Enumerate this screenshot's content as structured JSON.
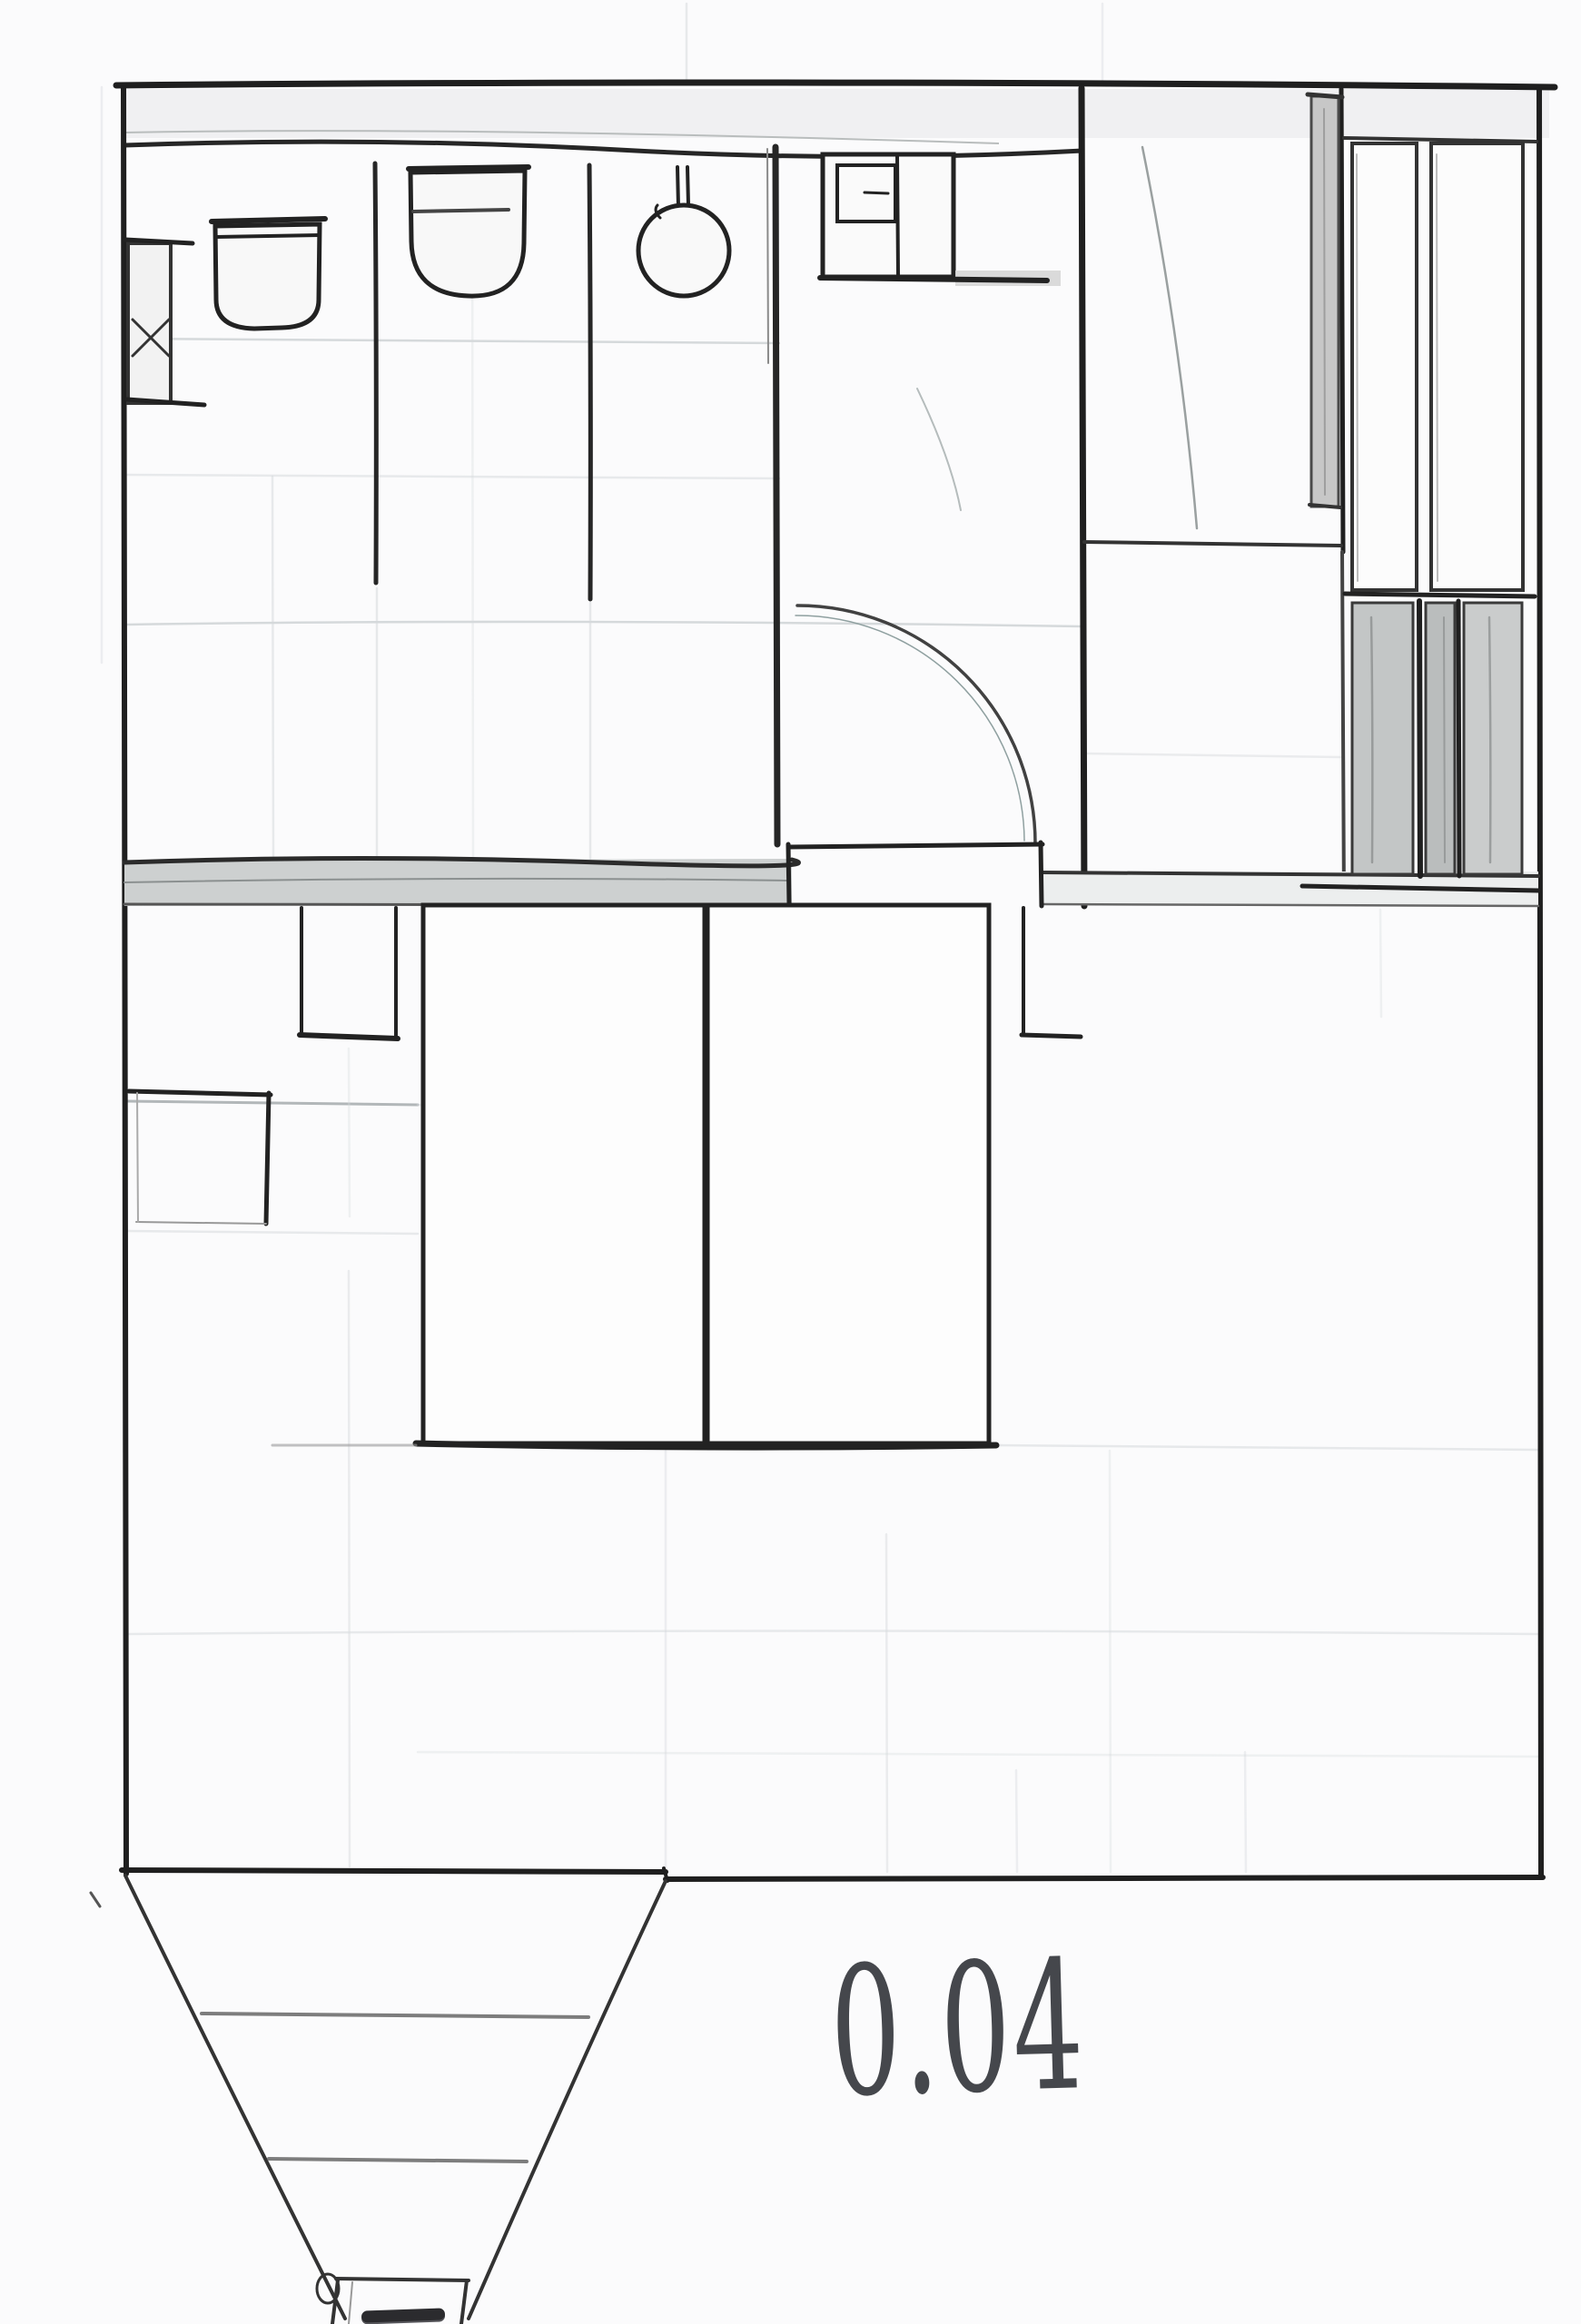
{
  "document": {
    "kind": "hand-drawn floor plan sketch",
    "room_label": "0.04"
  },
  "colors": {
    "paper": "#fbfbfc",
    "ink": "#1f1f1f",
    "ink_soft": "#555555",
    "pencil_grid": "#c9ced1",
    "wall_band_fill": "#ededed",
    "divider_fill": "#cdd0d0",
    "hatch_fill": "#c3c6c6",
    "shadow_fill": "#d4d4d4",
    "label_ink": "#45474c"
  },
  "fixtures": [
    "radiator-with-x",
    "toilet-1",
    "toilet-2",
    "toilet-bowl-3",
    "sink-unit",
    "door-swing-arc",
    "bed-left",
    "bed-right",
    "hanging-fixture-left",
    "hanging-fixture-right",
    "side-table",
    "shaft-hatch-bars",
    "funnel-chute"
  ]
}
